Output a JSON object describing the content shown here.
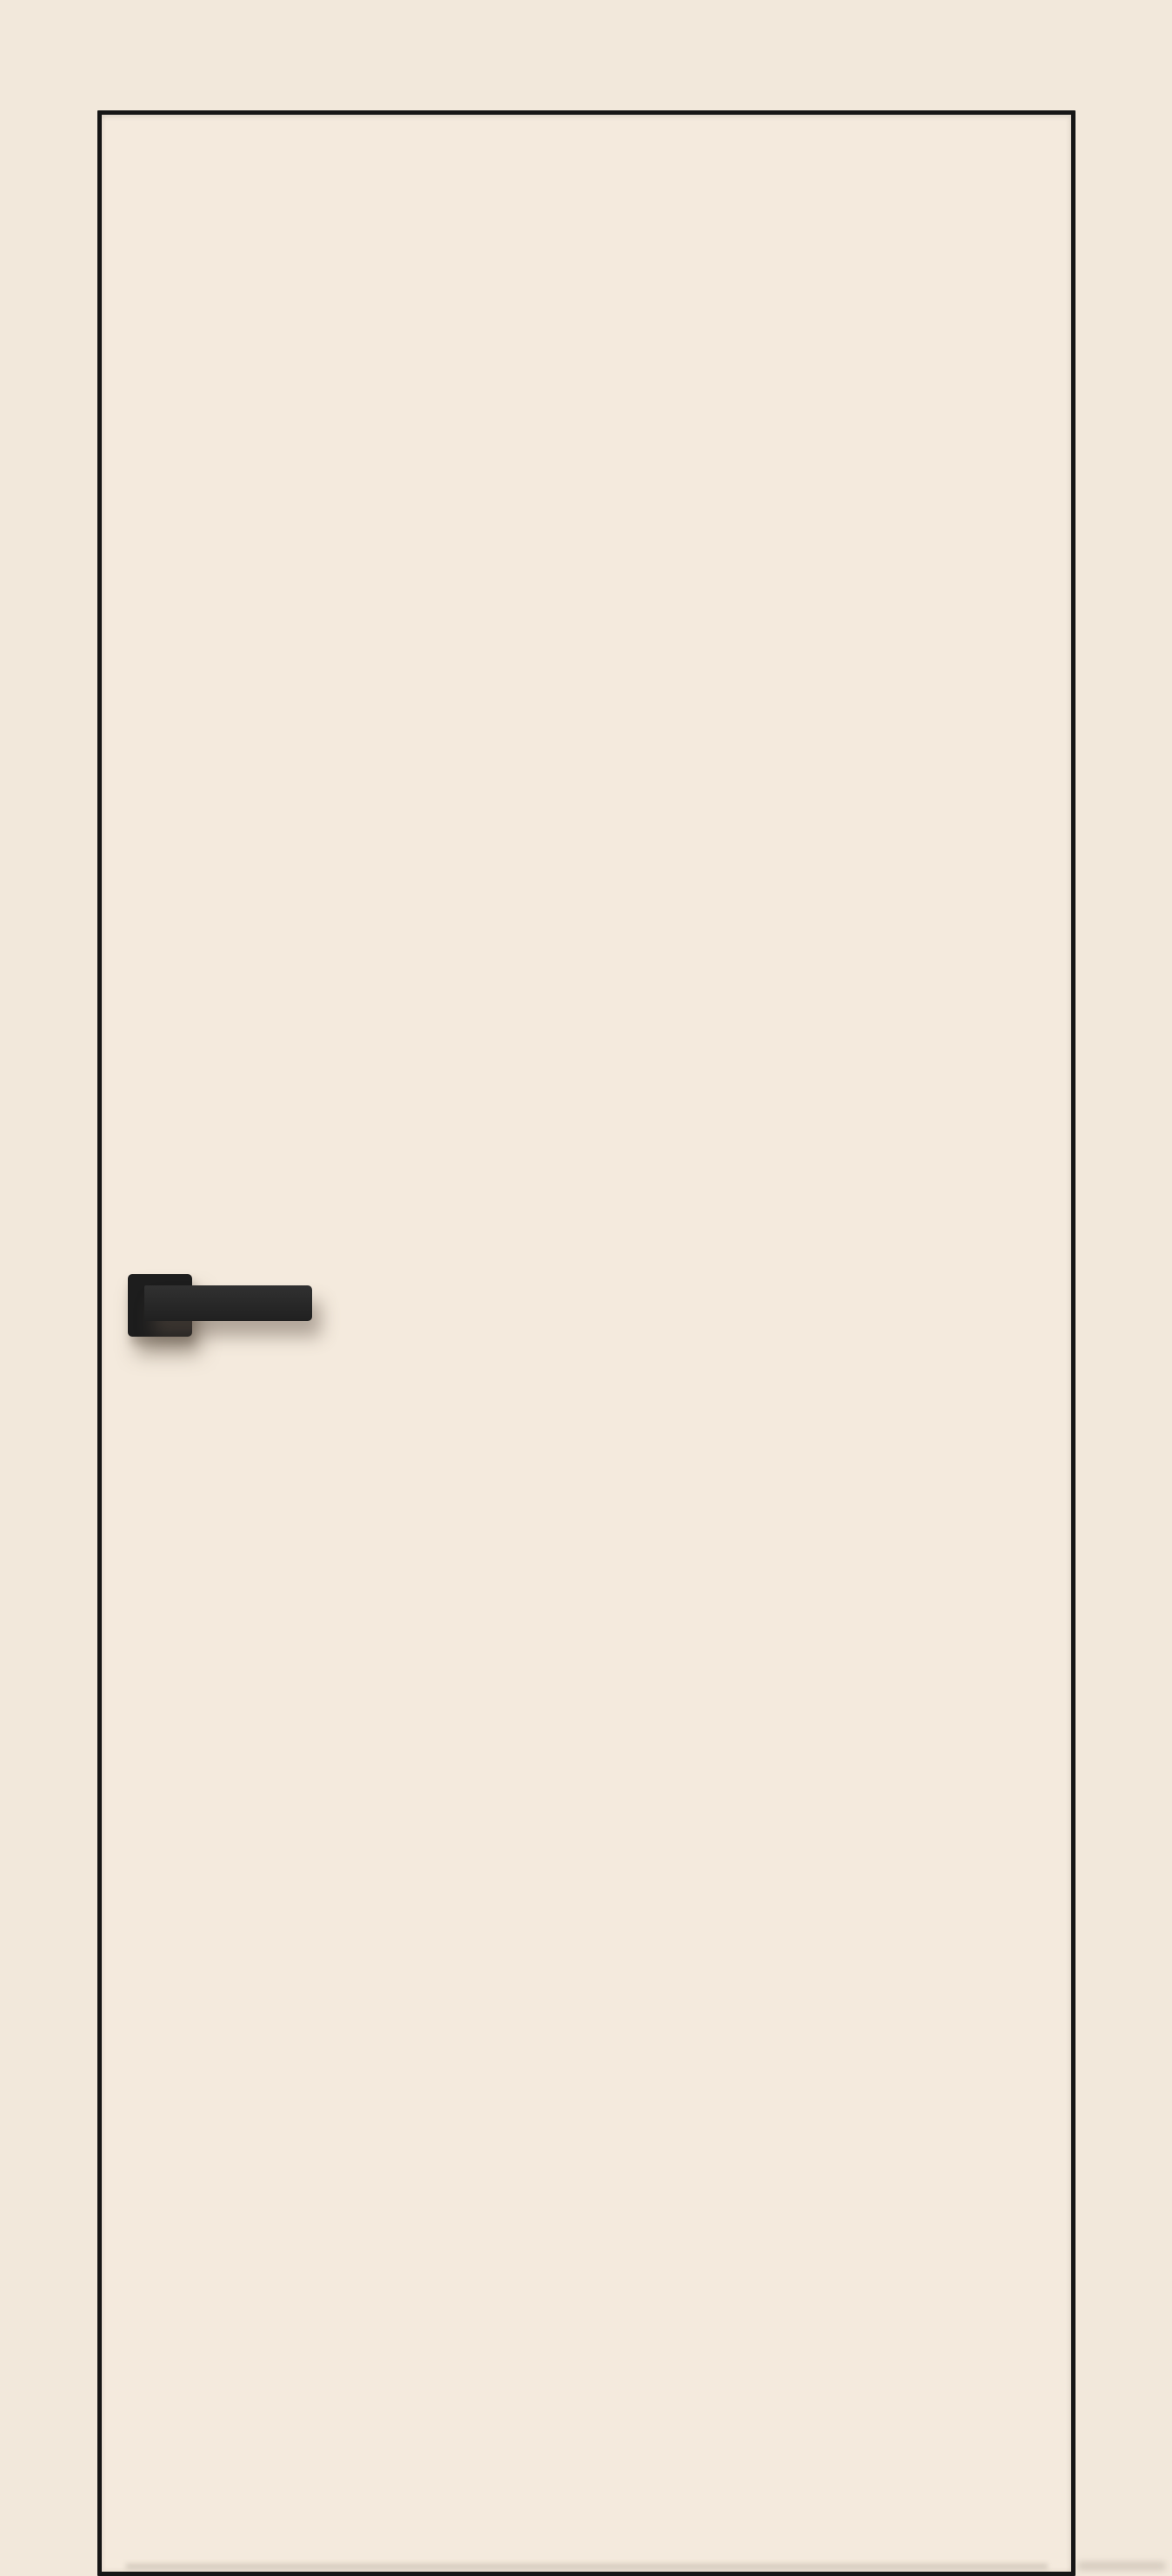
{
  "scene": {
    "colors": {
      "background": "#f2e8db",
      "door_face": "#f4eadd",
      "door_edge": "#161616",
      "handle_rosette": "#1d1d1d",
      "handle_lever": "#242424",
      "shadow": "rgba(95,83,70,0.5)"
    }
  }
}
